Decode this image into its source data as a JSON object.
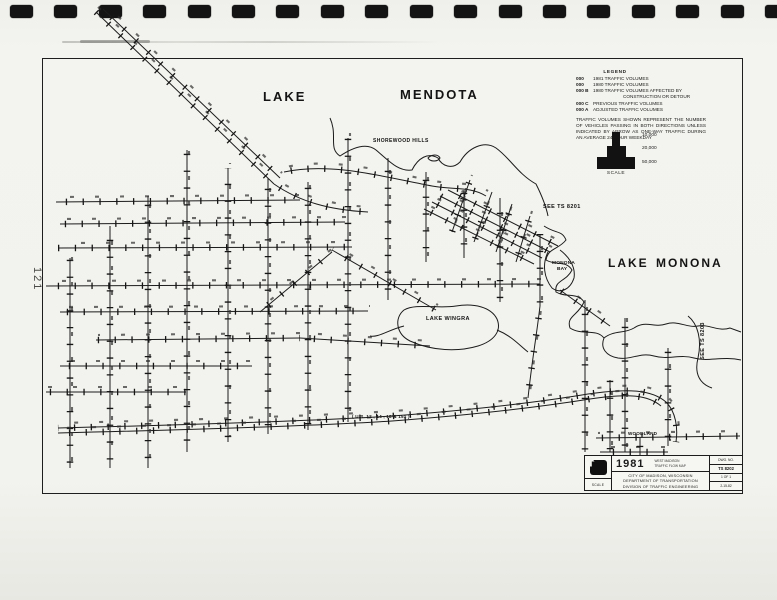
{
  "page": {
    "number": "121"
  },
  "binder": {
    "hole_count": 18
  },
  "labels": {
    "lake_mendota_w1": "LAKE",
    "lake_mendota_w2": "MENDOTA",
    "shorewood_hills": "SHOREWOOD HILLS",
    "see_ts_8201": "SEE TS 8201",
    "see_ts_8203": "SEE TS 8203",
    "lake_monona_w1": "LAKE",
    "lake_monona_w2": "MONONA",
    "monona_bay_l1": "MONONA",
    "monona_bay_l2": "BAY",
    "lake_wingra": "LAKE WINGRA",
    "beltline": "( U.S. 12 , 14 , 18  &  151 )",
    "woodland": "WOODLAND"
  },
  "legend": {
    "title": "LEGEND",
    "rows": [
      {
        "sym": "000",
        "text": "1981 TRAFFIC VOLUMES"
      },
      {
        "sym": "000",
        "text": "1980 TRAFFIC VOLUMES"
      },
      {
        "sym": "000 B",
        "text": "1980 TRAFFIC VOLUMES AFFECTED BY"
      },
      {
        "sym": "",
        "text": "CONSTRUCTION OR DETOUR"
      },
      {
        "sym": "000 C",
        "text": "PREVIOUS TRAFFIC VOLUMES"
      },
      {
        "sym": "000 A",
        "text": "ADJUSTED TRAFFIC VOLUMES"
      }
    ],
    "note": "TRAFFIC VOLUMES SHOWN REPRESENT THE NUMBER OF VEHICLES PASSING IN BOTH DIRECTIONS UNLESS INDICATED BY ARROW AS ONE-WAY TRAFFIC DURING AN AVERAGE 24 HOUR WEEKDAY"
  },
  "scale_figure": {
    "steps": [
      "10,000",
      "20,000",
      "50,000"
    ],
    "caption": "SCALE"
  },
  "title_block": {
    "year": "1981",
    "subtitle_line1": "WEST MADISON",
    "subtitle_line2": "TRAFFIC FLOW MAP",
    "org_line1": "CITY OF MADISON, WISCONSIN",
    "org_line2": "DEPARTMENT OF TRANSPORTATION",
    "org_line3": "DIVISION OF TRAFFIC ENGINEERING",
    "dwg_label": "DWG. NO.",
    "dwg_number": "TS 8202",
    "sheet": "1 OF 1",
    "date": "2-15-82",
    "scale_label": "SCALE"
  },
  "colors": {
    "ink": "#1b1b1b",
    "paper": "#f2f2ee"
  }
}
